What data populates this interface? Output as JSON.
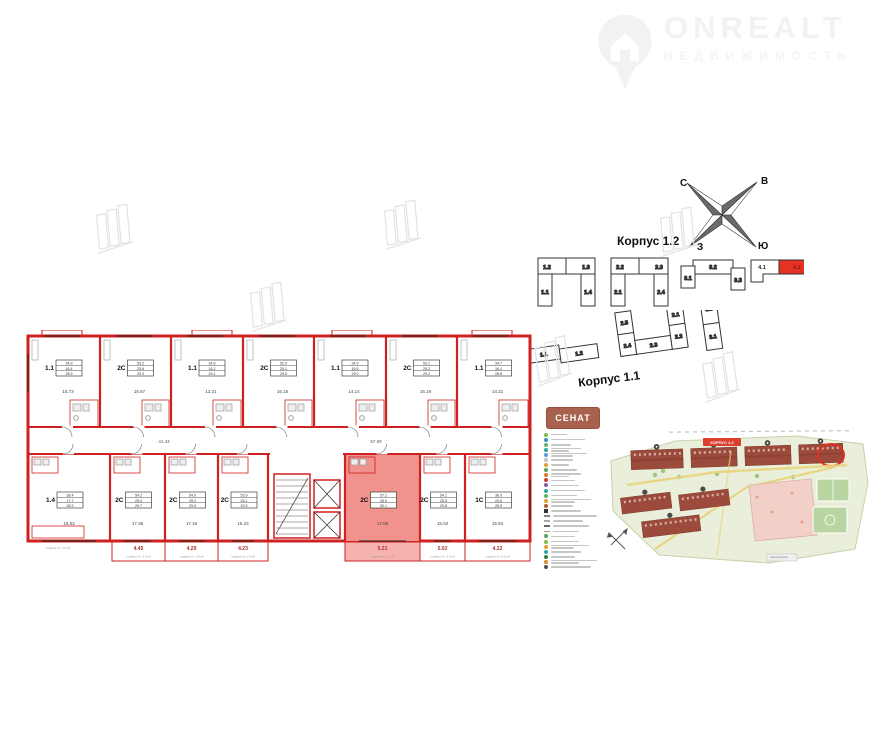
{
  "watermark": {
    "brand": "ONREALT",
    "subtitle": "НЕДВИЖИМОСТЬ"
  },
  "compass": {
    "north": "С",
    "east": "В",
    "west": "З",
    "south": "Ю"
  },
  "labels": {
    "korpus_12": "Корпус 1.2",
    "korpus_11": "Корпус 1.1"
  },
  "sections": {
    "row1": [
      [
        "1.2",
        "1.3",
        "1.1",
        "1.4"
      ],
      [
        "2.2",
        "2.3",
        "2.1",
        "2.4"
      ],
      [
        "3.2",
        "3.1",
        "3.3"
      ],
      [
        "4.1",
        "4.2"
      ]
    ],
    "row2": [
      [
        "1.1",
        "1.2"
      ],
      [
        "2.5",
        "2.4",
        "2.3",
        "2.1",
        "2.2"
      ],
      [
        "3.3",
        "3.1"
      ]
    ],
    "highlighted": "4.2"
  },
  "floorplan": {
    "colors": {
      "wall": "#ce2121",
      "highlight": "#f2928d",
      "highlight_balcony": "#f6b3ae"
    },
    "top_units": [
      {
        "label": "1.1",
        "areas": [
          "34.9",
          "16.4",
          "28.9"
        ],
        "room": "15.73"
      },
      {
        "label": "2С",
        "areas": [
          "53.2",
          "25.6",
          "29.3"
        ],
        "room": "16.67"
      },
      {
        "label": "1.1",
        "areas": [
          "34.8",
          "16.2",
          "29.1"
        ],
        "room": "13.31"
      },
      {
        "label": "2С",
        "areas": [
          "52.9",
          "25.1",
          "29.5"
        ],
        "room": "16.15"
      },
      {
        "label": "1.1",
        "areas": [
          "34.9",
          "16.5",
          "29.0"
        ],
        "room": "14.14"
      },
      {
        "label": "2С",
        "areas": [
          "53.1",
          "25.3",
          "29.2"
        ],
        "room": "16.19"
      },
      {
        "label": "1.1",
        "areas": [
          "34.7",
          "16.1",
          "28.8"
        ],
        "room": "14.21"
      }
    ],
    "bottom_units": [
      {
        "label": "1.4",
        "areas": [
          "38.4",
          "17.7",
          "28.3"
        ],
        "room": "15.53"
      },
      {
        "label": "2С",
        "areas": [
          "54.2",
          "25.4",
          "29.7"
        ],
        "room": "17.38"
      },
      {
        "label": "2С",
        "areas": [
          "54.0",
          "25.2",
          "29.5"
        ],
        "room": "17.16"
      },
      {
        "label": "2С",
        "areas": [
          "53.9",
          "25.1",
          "29.3"
        ],
        "room": "16.23"
      },
      {
        "label": "2С",
        "highlight": true,
        "areas": [
          "57.2",
          "26.9",
          "30.1"
        ],
        "room": "17.05"
      },
      {
        "label": "2С",
        "areas": [
          "54.1",
          "25.5",
          "29.8"
        ],
        "room": "15.02"
      },
      {
        "label": "1С",
        "areas": [
          "36.9",
          "20.6",
          "28.9"
        ],
        "room": "15.94"
      }
    ],
    "balconies": [
      {
        "v": "4.45"
      },
      {
        "v": "4.29"
      },
      {
        "v": "4.23"
      },
      {
        "v": "5.21",
        "highlight": true
      },
      {
        "v": "5.02"
      },
      {
        "v": "4.22"
      }
    ],
    "balcony_caption": "лоджия пл. 2.6 м²",
    "corridor_areas": [
      "41.34",
      "57.09"
    ]
  },
  "siteplan": {
    "logo": "СЕНАТ",
    "badge": "КОРПУС 1.2",
    "colors": {
      "plot": "#e9efdb",
      "plot_border": "#c6d2a8",
      "building": "#9c4a3c",
      "building_dark": "#7d392d",
      "path": "#e8d47c",
      "playground": "#f2cfc7",
      "court": "#b9d5a2",
      "ring": "#e02f1f",
      "badge_bg": "#d94030",
      "tree": "#8fbf6f"
    },
    "legend": [
      {
        "c": "#7ac143",
        "w": 16
      },
      {
        "c": "#3f8fc5",
        "w": 34
      },
      {
        "c": "#65b46a",
        "w": 20
      },
      {
        "c": "#2ba8a4",
        "w": 30,
        "l": 2
      },
      {
        "c": "#5a9bd4",
        "w": 36,
        "l": 2
      },
      {
        "c": "#b9c3c9",
        "w": 22
      },
      {
        "c": "#e89b2d",
        "w": 18
      },
      {
        "c": "#57a45b",
        "w": 26
      },
      {
        "c": "#e0762e",
        "w": 30,
        "l": 2
      },
      {
        "c": "#cb4136",
        "w": 24
      },
      {
        "c": "#8e5aa8",
        "w": 28
      },
      {
        "c": "#2ba8a4",
        "w": 34
      },
      {
        "c": "#65b46a",
        "w": 26
      },
      {
        "c": "#e3a32f",
        "w": 40,
        "l": 2
      },
      {
        "c": "#b0582f",
        "w": 22
      },
      {
        "t": "sq",
        "c": "#333333",
        "w": 30
      },
      {
        "t": "line",
        "c": "#888888",
        "w": 44
      },
      {
        "t": "line",
        "c": "#aaaaaa",
        "w": 30
      },
      {
        "t": "line",
        "c": "#666666",
        "w": 36
      },
      {
        "t": "line",
        "c": "#999999",
        "w": 26
      },
      {
        "c": "#57a45b",
        "w": 24
      },
      {
        "c": "#7ac143",
        "w": 28
      },
      {
        "c": "#e89b2d",
        "w": 38,
        "l": 2
      },
      {
        "c": "#2ba8a4",
        "w": 30
      },
      {
        "c": "#3b7a3e",
        "w": 24
      },
      {
        "c": "#d98a2b",
        "w": 46,
        "l": 2
      },
      {
        "c": "#4d4d4d",
        "w": 40
      }
    ]
  }
}
